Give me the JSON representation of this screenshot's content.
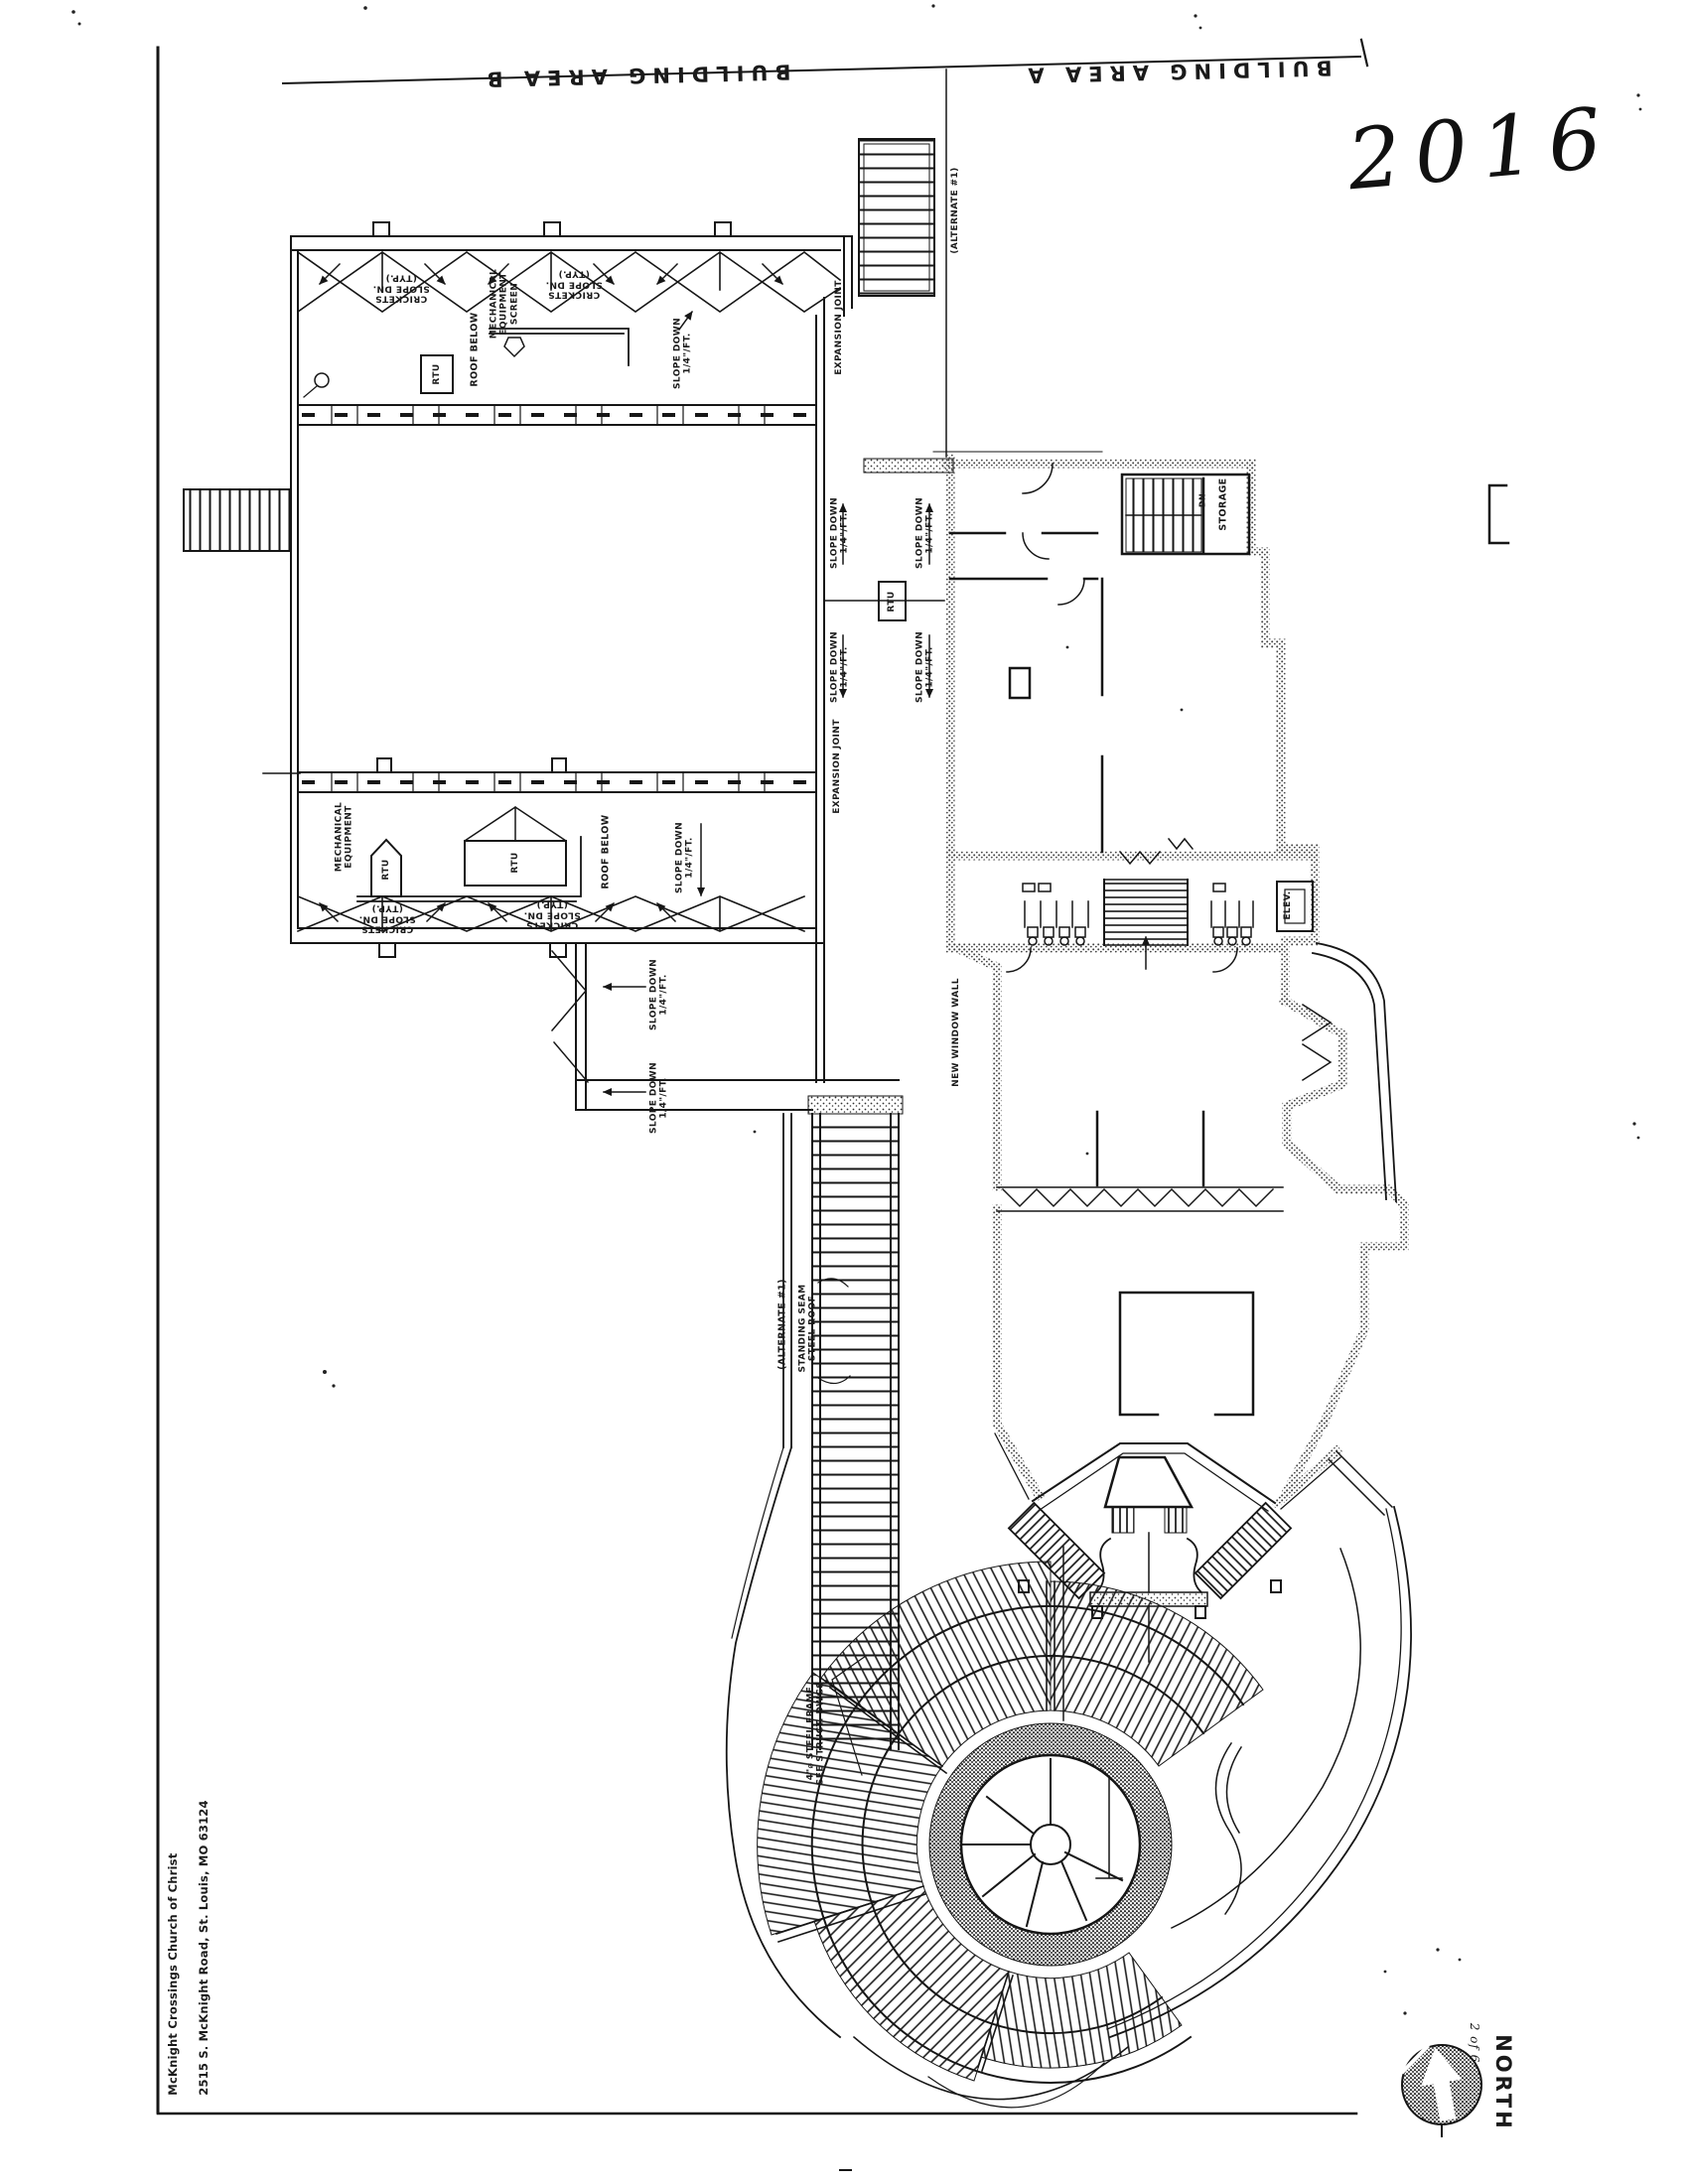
{
  "document": {
    "area_b_title": "BUILDING AREA B",
    "area_a_title": "BUILDING AREA A",
    "handwritten_year": "2016",
    "sheet_note": "2 of 6",
    "north_label": "NORTH",
    "firm_line1": "McKnight Crossings Church of Christ",
    "firm_line2": "2515 S. McKnight Road, St. Louis, MO 63124"
  },
  "roof_labels": {
    "crickets": "CRICKETS\nSLOPE DN.\n(TYP.)",
    "mech_screen": "MECHANICAL\nEQUIPMENT\nSCREEN",
    "mech_equip": "MECHANICAL\nEQUIPMENT",
    "roof_below": "ROOF BELOW",
    "slope_down": "SLOPE DOWN\n1/4\"/FT.",
    "expansion_joint": "EXPANSION JOINT",
    "rtu": "RTU",
    "alternate_1": "(ALTERNATE #1)",
    "standing_seam": "STANDING SEAM\nSTEEL ROOF",
    "steel_frame": "4\"⌀ STEEL FRAME\nSEE STRUCT. DWGS"
  },
  "plan_labels": {
    "storage": "STORAGE",
    "down": "DN",
    "elevator": "ELEV.",
    "new_window_wall": "NEW WINDOW WALL"
  }
}
